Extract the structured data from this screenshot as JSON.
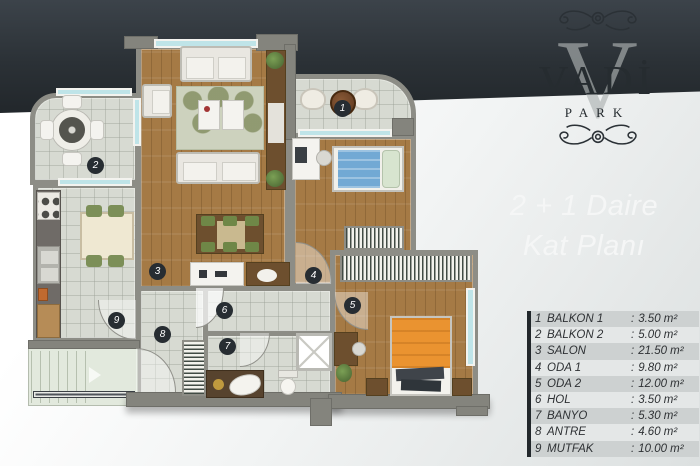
{
  "logo": {
    "watermark": "V",
    "name": "VADİ",
    "subtitle": "PARK"
  },
  "title": {
    "line1": "2 + 1 Daire",
    "line2": "Kat Planı"
  },
  "ui": {
    "colon": ":"
  },
  "legend": [
    {
      "num": "1",
      "name": "BALKON 1",
      "area": "3.50 m²"
    },
    {
      "num": "2",
      "name": "BALKON 2",
      "area": "5.00 m²"
    },
    {
      "num": "3",
      "name": "SALON",
      "area": "21.50 m²"
    },
    {
      "num": "4",
      "name": "ODA 1",
      "area": "9.80 m²"
    },
    {
      "num": "5",
      "name": "ODA 2",
      "area": "12.00 m²"
    },
    {
      "num": "6",
      "name": "HOL",
      "area": "3.50 m²"
    },
    {
      "num": "7",
      "name": "BANYO",
      "area": "5.30 m²"
    },
    {
      "num": "8",
      "name": "ANTRE",
      "area": "4.60 m²"
    },
    {
      "num": "9",
      "name": "MUTFAK",
      "area": "10.00 m²"
    }
  ],
  "colors": {
    "band_dark": "#2b3136",
    "wood_floor": "#a57a45",
    "tile_floor": "#d7dad2",
    "window_glass": "#bfe4e8",
    "bed_orange": "#ea9330",
    "bed_blue": "#72a9d4",
    "legend_row_gray": "#cdd1d1"
  }
}
